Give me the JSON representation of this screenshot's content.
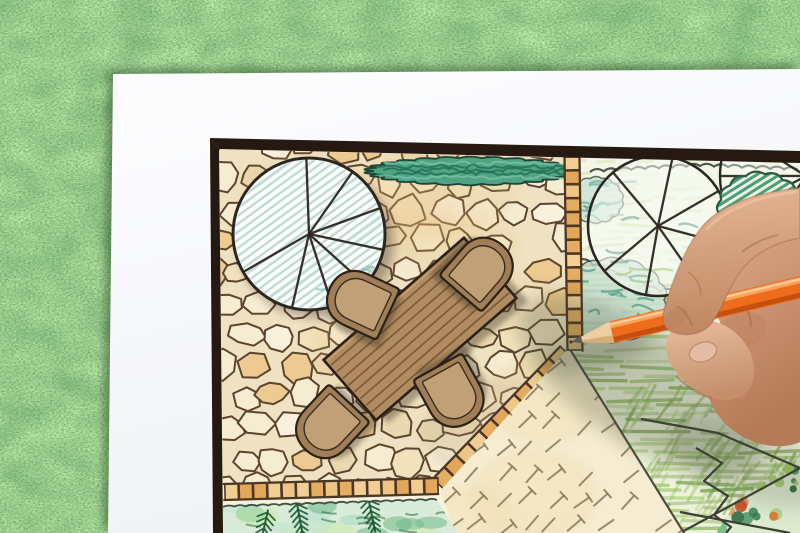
{
  "scene": {
    "description": "Overhead photo of a hand holding an orange colored pencil, drawing a garden landscape design plan (flagstone patio, dining table with four chairs, tree and shrub symbols, hedge, lawn and gravel areas) on a white sheet of paper lying on green grass",
    "elements": [
      "grass-lawn",
      "white-paper-sheet",
      "plan-black-frame",
      "flagstone-patio",
      "shade-tree-symbol",
      "hedge-strip",
      "tile-borders",
      "dining-table",
      "garden-chairs",
      "garden-tree-symbols",
      "shrub-masses",
      "hatched-lawn",
      "gravel-area",
      "planting-beds",
      "human-hand",
      "orange-colored-pencil"
    ]
  },
  "palette": {
    "paper": "#f7f8fa",
    "frame": "#261911",
    "planPaper": "#f7f1de",
    "stoneJoint": "#efe2c2",
    "stoneLine": "#5c442e",
    "stoneFills": [
      "#f6ecd2",
      "#f1e2bd",
      "#ead8b0",
      "#ecca92",
      "#f8f0dc"
    ],
    "tileFills": [
      "#e2a75b",
      "#eec584",
      "#e5ad62",
      "#f0cf95"
    ],
    "tileLine": "#4c3726",
    "hedgeFill": "#4fa485",
    "hedgeDark": "#1d6b50",
    "hedgeLight": "#7cc4a6",
    "hedgeLine": "#1f4435",
    "treeOutline": "#2c2620",
    "treeFill": "#fbfdfa",
    "treeHatch": "#b7d4cf",
    "treeHatchDark": "#8ec3b6",
    "gardenBase": "#edf2da",
    "lawnStrokes": [
      "#9cc46e",
      "#86b258",
      "#b3d489",
      "#769f4b"
    ],
    "upperStrokes": [
      "#c8df9f",
      "#d8e8b8",
      "#b9d48d"
    ],
    "scallopLine": "#39433a",
    "teal": "#6fae9c",
    "tealDark": "#4f9887",
    "massFill": "#c7e0d4",
    "blobFill": "#eef5ea",
    "blobHatch": "#2f8f63",
    "blobLine": "#2c5a40",
    "gravelFill": "#f6ecd1",
    "gravelWash": "#eed9a6",
    "dashColor": "#8a795c",
    "boundaryLine": "#4a4438",
    "bedFill": "#d9ecd9",
    "bedBlobs": [
      "#bfe3cf",
      "#8fcf9e",
      "#cde9a8",
      "#6fb98a",
      "#a5d9c3"
    ],
    "fern": "#1d5a36",
    "bedLine": "#41503f",
    "woodTable": "#b18c60",
    "woodDark": "#6d5134",
    "woodLine": "#2d2015",
    "chairOuter": "#9f7e58",
    "chairInner": "#c2a077",
    "shadow": "rgba(45,35,22,0.38)",
    "softShadow": "#3f4a33",
    "vegCols": [
      "#2e7d4c",
      "#48a05e",
      "#e0762e",
      "#c4502a",
      "#9cc45c",
      "#1e5c36"
    ],
    "pencilBody": "#ee6d1c",
    "pencilHi": "#ffa257",
    "pencilLo": "#c4500f",
    "pencilSpec": "#ffd9b8",
    "wood": "#e9cfa2",
    "woodShade": "#cfa96e",
    "graphite": "#5f5b52",
    "crease": "#a06a48"
  },
  "geometry": {
    "paper": [
      [
        113,
        74
      ],
      [
        800,
        69
      ],
      [
        800,
        533
      ],
      [
        108,
        533
      ]
    ],
    "frameTop": [
      [
        210,
        138
      ],
      [
        800,
        151
      ],
      [
        800,
        163
      ],
      [
        219,
        149
      ]
    ],
    "frameLeft": [
      [
        210,
        138
      ],
      [
        219,
        149
      ],
      [
        223,
        533
      ],
      [
        213,
        533
      ]
    ],
    "planClip": [
      [
        219,
        148
      ],
      [
        800,
        160
      ],
      [
        800,
        533
      ],
      [
        222,
        533
      ]
    ],
    "patio": [
      [
        219,
        149
      ],
      [
        566,
        158
      ],
      [
        566,
        351
      ],
      [
        437,
        485
      ],
      [
        223,
        492
      ]
    ],
    "garden": [
      [
        566,
        157
      ],
      [
        800,
        161
      ],
      [
        800,
        533
      ],
      [
        684,
        533
      ],
      [
        571,
        351
      ],
      [
        566,
        351
      ]
    ],
    "gravel": [
      [
        571,
        351
      ],
      [
        684,
        533
      ],
      [
        456,
        533
      ],
      [
        440,
        491
      ],
      [
        566,
        351
      ]
    ],
    "bed": [
      [
        223,
        505
      ],
      [
        436,
        499
      ],
      [
        458,
        533
      ],
      [
        223,
        533
      ]
    ],
    "veg": [
      [
        738,
        500
      ],
      [
        800,
        456
      ],
      [
        800,
        533
      ],
      [
        716,
        533
      ]
    ],
    "tileStrips": [
      {
        "p1": [
          572,
          157
        ],
        "p2": [
          575,
          351
        ],
        "w": 15,
        "n": 14
      },
      {
        "p1": [
          566,
          352
        ],
        "p2": [
          438,
          485
        ],
        "w": 16,
        "n": 11
      },
      {
        "p1": [
          438,
          486
        ],
        "p2": [
          224,
          492
        ],
        "w": 16,
        "n": 15
      }
    ],
    "hedge": {
      "cx": 470,
      "cy": 171,
      "rx": 96,
      "ry": 13
    },
    "tree1": {
      "cx": 309,
      "cy": 234,
      "r": 76,
      "spokes": [
        -92,
        -55,
        -20,
        12,
        42,
        72,
        103,
        150
      ],
      "hatchAngle": -36
    },
    "tree2": {
      "cx": 658,
      "cy": 226,
      "r": 70,
      "spokes": [
        -78,
        -30,
        15,
        55,
        100,
        140,
        -130
      ]
    },
    "tree3": {
      "cx": 806,
      "cy": 176,
      "r": 86,
      "spokes": [
        95,
        125,
        152,
        180,
        212
      ]
    },
    "masses": [
      {
        "cx": 612,
        "cy": 300,
        "rx": 52,
        "ry": 40
      },
      {
        "cx": 596,
        "cy": 200,
        "rx": 26,
        "ry": 22
      }
    ],
    "darkBlob": {
      "cx": 760,
      "cy": 208,
      "rx": 40,
      "ry": 34,
      "hatchAngle": -32
    },
    "scallops": [
      [
        [
          590,
          172
        ],
        [
          700,
          166
        ],
        [
          798,
          170
        ]
      ],
      [
        [
          566,
          254
        ],
        [
          660,
          292
        ],
        [
          724,
          286
        ]
      ]
    ],
    "table": {
      "cx": 420,
      "cy": 329,
      "len": 186,
      "wid": 80,
      "rot": -41,
      "planks": 8
    },
    "chairs": [
      {
        "x": 361,
        "y": 302,
        "rot": 25
      },
      {
        "x": 480,
        "y": 271,
        "rot": 131
      },
      {
        "x": 329,
        "y": 425,
        "rot": -47
      },
      {
        "x": 452,
        "y": 393,
        "rot": -119
      }
    ],
    "jagged": [
      [
        [
          696,
          448
        ],
        [
          722,
          463
        ],
        [
          704,
          481
        ],
        [
          728,
          496
        ],
        [
          714,
          515
        ],
        [
          731,
          527
        ],
        [
          726,
          533
        ]
      ],
      [
        [
          641,
          419
        ],
        [
          718,
          433
        ],
        [
          800,
          468
        ]
      ],
      [
        [
          680,
          533
        ],
        [
          800,
          468
        ]
      ],
      [
        [
          680,
          512
        ],
        [
          790,
          533
        ]
      ]
    ],
    "pencil": {
      "tip": [
        571,
        342
      ],
      "end": [
        806,
        286
      ],
      "halfW": 11,
      "coneLen": 42,
      "leadLen": 11
    },
    "shadows": [
      {
        "cx": 640,
        "cy": 385,
        "rx": 140,
        "ry": 58,
        "rot": 33,
        "op": 0.26
      },
      {
        "cx": 598,
        "cy": 352,
        "rx": 55,
        "ry": 16,
        "rot": -12,
        "op": 0.3
      },
      {
        "cx": 752,
        "cy": 462,
        "rx": 86,
        "ry": 38,
        "rot": 20,
        "op": 0.18
      }
    ],
    "ferns": [
      [
        300,
        520
      ],
      [
        264,
        528
      ],
      [
        372,
        516
      ]
    ]
  }
}
